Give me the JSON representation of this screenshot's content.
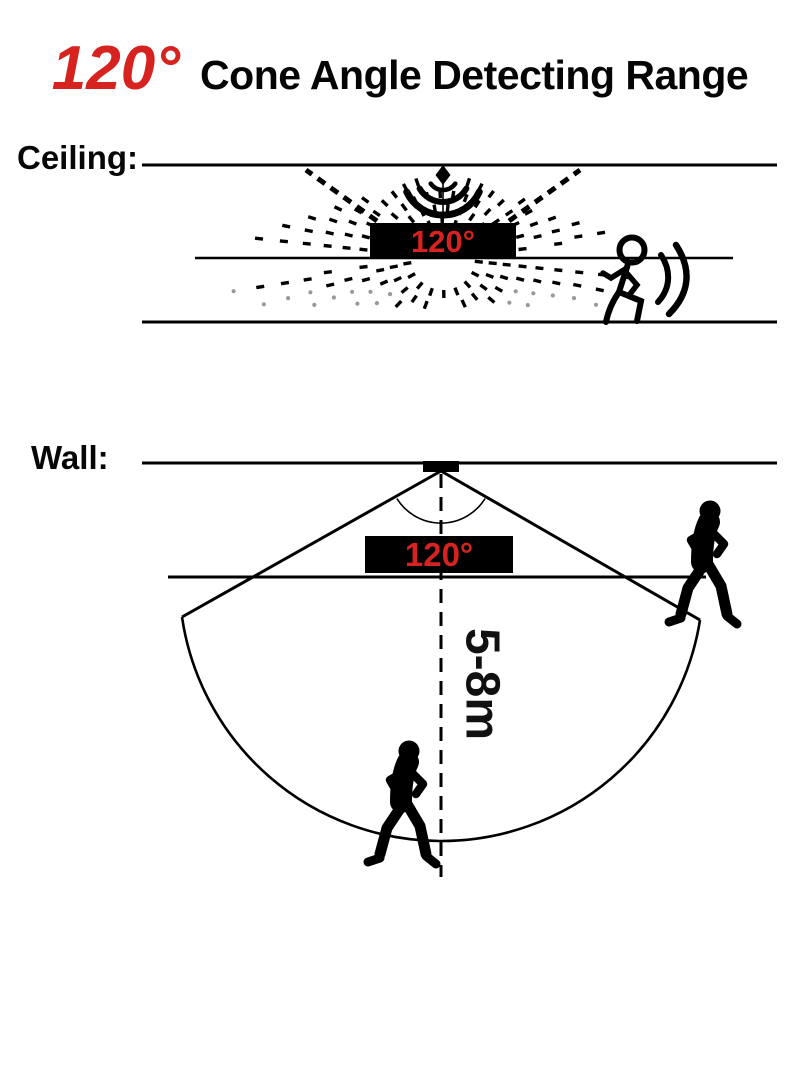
{
  "title": {
    "angle_highlight": "120°",
    "text": "Cone Angle Detecting Range"
  },
  "sections": {
    "ceiling": {
      "label": "Ceiling:",
      "sensor_angle_label": "120°"
    },
    "wall": {
      "label": "Wall:",
      "sensor_angle_label": "120°",
      "detection_range_label": "5-8m"
    }
  },
  "colors": {
    "accent_red": "#d6231f",
    "ink": "#000000",
    "gray_dot": "#999999",
    "label_bg": "#000000"
  }
}
